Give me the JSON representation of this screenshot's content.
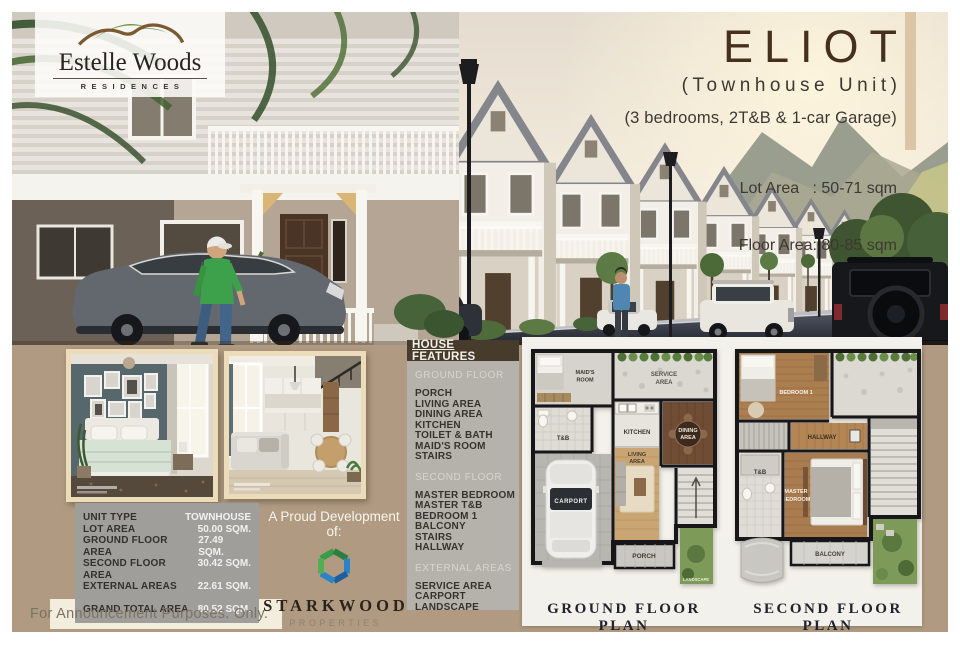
{
  "brand": {
    "name": "Estelle Woods",
    "subtitle": "RESIDENCES"
  },
  "unit": {
    "title": "ELIOT",
    "subtitle": "(Townhouse Unit)",
    "description": "(3 bedrooms, 2T&B & 1-car Garage)",
    "lot_area": "Lot Area   : 50-71 sqm",
    "floor_area": "Floor Area: 80-85 sqm"
  },
  "specs": {
    "rows": [
      {
        "label": "UNIT TYPE",
        "value": "TOWNHOUSE"
      },
      {
        "label": "LOT AREA",
        "value": "50.00 SQM."
      },
      {
        "label": "GROUND FLOOR AREA",
        "value": "27.49 SQM."
      },
      {
        "label": "SECOND FLOOR AREA",
        "value": "30.42 SQM."
      },
      {
        "label": "EXTERNAL AREAS",
        "value": "22.61 SQM."
      }
    ],
    "total": {
      "label": "GRAND TOTAL AREA",
      "value": "80.52 SQM."
    }
  },
  "features": {
    "header": "HOUSE FEATURES",
    "sections": [
      {
        "title": "GROUND FLOOR",
        "items": [
          "PORCH",
          "LIVING AREA",
          "DINING AREA",
          "KITCHEN",
          "TOILET & BATH",
          "MAID'S ROOM",
          "STAIRS"
        ]
      },
      {
        "title": "SECOND FLOOR",
        "items": [
          "MASTER BEDROOM",
          "MASTER T&B",
          "BEDROOM 1",
          "BALCONY",
          "STAIRS",
          "HALLWAY"
        ]
      },
      {
        "title": "EXTERNAL AREAS",
        "items": [
          "SERVICE AREA",
          "CARPORT",
          "LANDSCAPE"
        ]
      }
    ]
  },
  "developer": {
    "line": "A Proud Development of:",
    "name": "STARKWOOD",
    "type": "PROPERTIES"
  },
  "plans": {
    "ground": {
      "label": "GROUND FLOOR PLAN",
      "rooms": {
        "maids_1": "MAID'S",
        "maids_2": "ROOM",
        "service_1": "SERVICE",
        "service_2": "AREA",
        "tb": "T&B",
        "kitchen": "KITCHEN",
        "dining_1": "DINING",
        "dining_2": "AREA",
        "living_1": "LIVING",
        "living_2": "AREA",
        "carport": "CARPORT",
        "porch": "PORCH",
        "landscape": "LANDSCAPE"
      }
    },
    "second": {
      "label": "SECOND FLOOR PLAN",
      "rooms": {
        "bedroom": "BEDROOM 1",
        "hallway": "HALLWAY",
        "master_1": "MASTER",
        "master_2": "BEDROOM",
        "tb": "T&B",
        "balcony": "BALCONY"
      }
    }
  },
  "footer": {
    "note": "For Announcement Purposes. Only."
  },
  "palette": {
    "tan_background": "#b09b82",
    "accent_bar": "#dbc5a4",
    "title_brown": "#46301d",
    "features_panel": "#b5b2ac",
    "features_header": "#473b2b",
    "table_gray": "#a09e9a",
    "plan_panel": "#f3f1eb",
    "cream": "#f3edde",
    "brand_green": "#6f943c",
    "starkwood_green": "#3a9c46",
    "starkwood_blue": "#2a83c6"
  }
}
